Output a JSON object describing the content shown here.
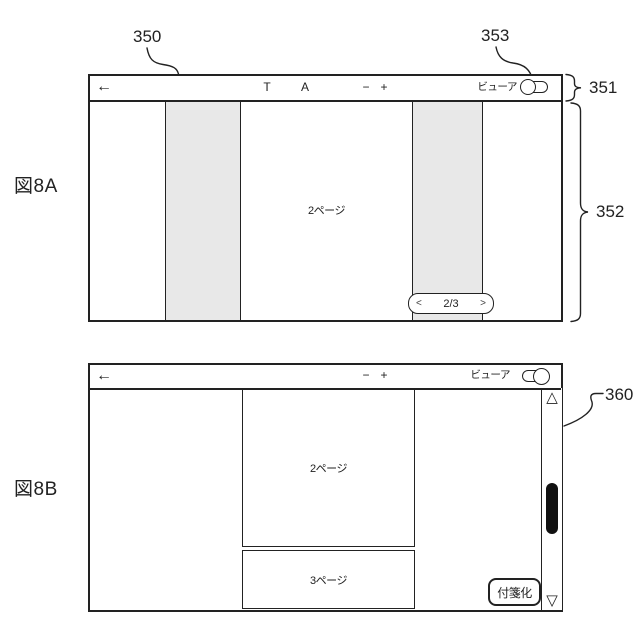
{
  "figure": {
    "fig_a_label": "図8A",
    "fig_b_label": "図8B"
  },
  "annotations": {
    "ref_350": "350",
    "ref_351": "351",
    "ref_352": "352",
    "ref_353": "353",
    "ref_360": "360",
    "ref_361": "361"
  },
  "viewer_a": {
    "toolbar": {
      "back_icon": "←",
      "text_tool": "T",
      "font_tool": "A",
      "zoom_out": "−",
      "zoom_in": "+",
      "viewer_label": "ビューア",
      "toggle_state": "off"
    },
    "page_label": "2ページ",
    "pager": {
      "prev_icon": "<",
      "value": "2/3",
      "next_icon": ">"
    }
  },
  "viewer_b": {
    "toolbar": {
      "back_icon": "←",
      "zoom_out": "−",
      "zoom_in": "+",
      "viewer_label": "ビューア",
      "toggle_state": "on"
    },
    "page2_label": "2ページ",
    "page3_label": "3ページ",
    "sticky_note_button": "付箋化",
    "scrollbar": {
      "up_icon": "△",
      "down_icon": "▽"
    }
  },
  "colors": {
    "line": "#222222",
    "shade": "#e8e8e8",
    "thumb": "#111111",
    "background": "#ffffff"
  }
}
